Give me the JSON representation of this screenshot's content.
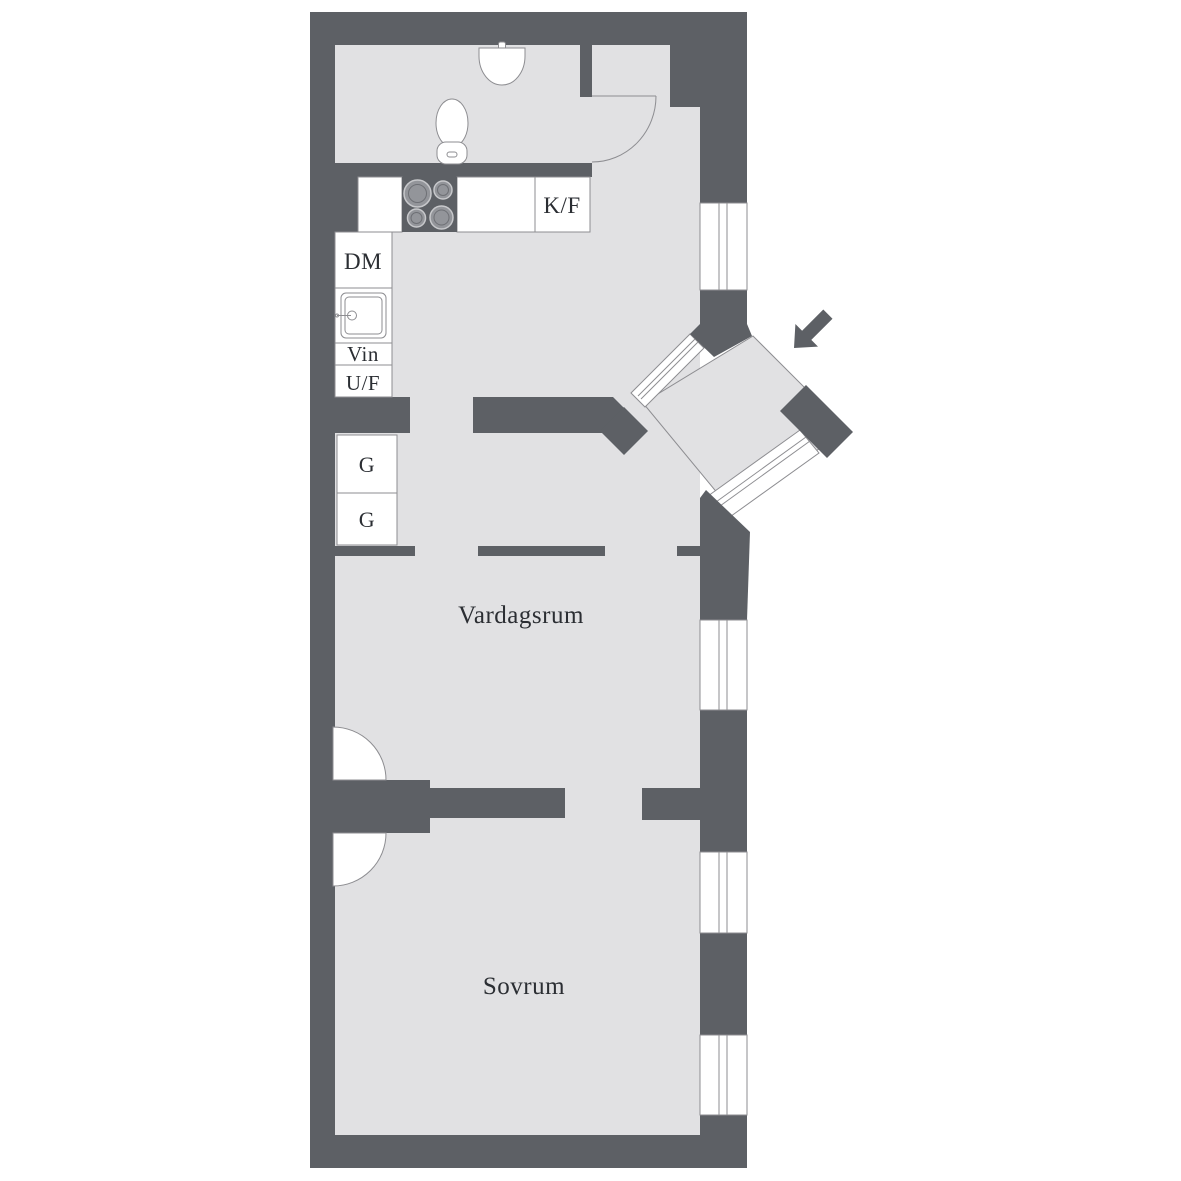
{
  "floorplan": {
    "rooms": [
      {
        "name": "living-room",
        "label": "Vardagsrum"
      },
      {
        "name": "bedroom",
        "label": "Sovrum"
      }
    ],
    "kitchen_units": {
      "fridge_freezer": "K/F",
      "dishwasher": "DM",
      "wine": "Vin",
      "oven_freezer": "U/F"
    },
    "wardrobes": [
      {
        "label": "G"
      },
      {
        "label": "G"
      }
    ],
    "colors": {
      "wall": "#5d6065",
      "floor": "#e1e1e3",
      "line": "#8d8d91",
      "text": "#2b2e33",
      "white": "#ffffff",
      "burner": "#93959a",
      "background": "#ffffff"
    }
  }
}
